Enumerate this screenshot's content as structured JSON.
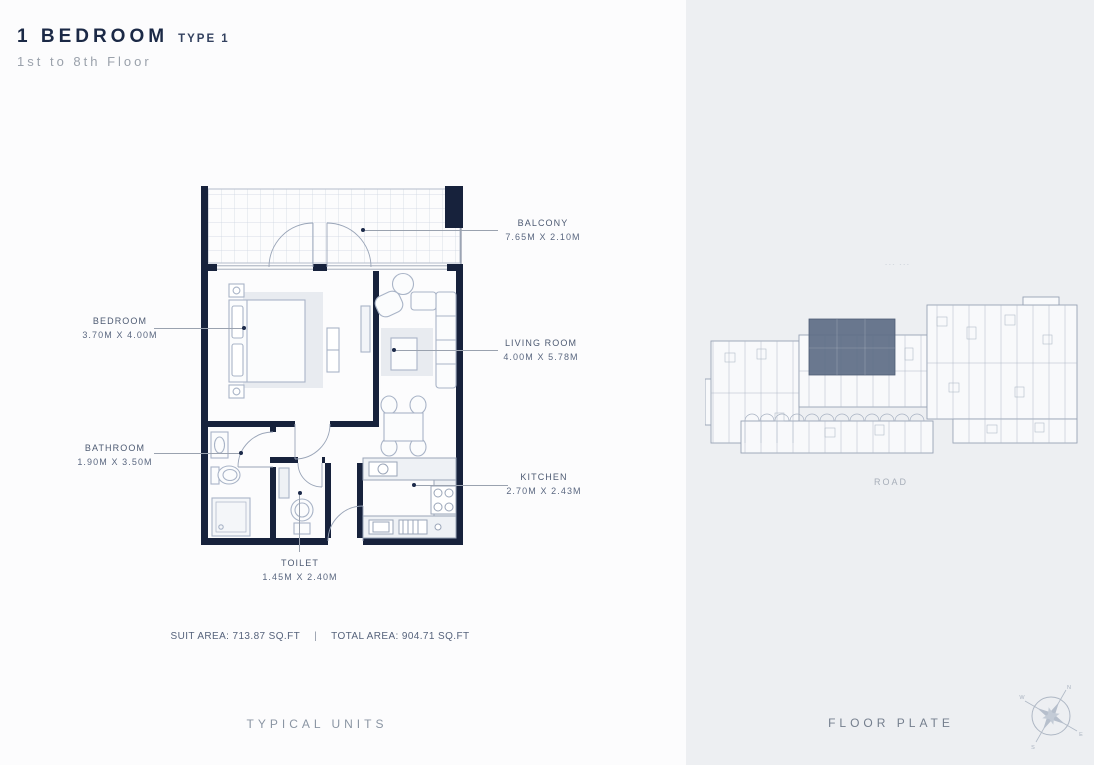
{
  "header": {
    "title": "1 BEDROOM",
    "type": "TYPE 1",
    "floors": "1st to 8th Floor"
  },
  "unit_plan": {
    "rooms": [
      {
        "name": "BALCONY",
        "dims": "7.65M X 2.10M"
      },
      {
        "name": "BEDROOM",
        "dims": "3.70M X 4.00M"
      },
      {
        "name": "LIVING ROOM",
        "dims": "4.00M X 5.78M"
      },
      {
        "name": "BATHROOM",
        "dims": "1.90M X 3.50M"
      },
      {
        "name": "TOILET",
        "dims": "1.45M X 2.40M"
      },
      {
        "name": "KITCHEN",
        "dims": "2.70M X 2.43M"
      }
    ],
    "areas": {
      "suit": "SUIT AREA: 713.87 SQ.FT",
      "separator": "|",
      "total": "TOTAL AREA: 904.71 SQ.FT"
    },
    "section_label": "TYPICAL UNITS"
  },
  "floor_plate": {
    "section_label": "FLOOR PLATE",
    "road_label": "ROAD",
    "tick_marks": "--- ---",
    "compass": {
      "n": "N",
      "e": "E",
      "s": "S",
      "w": "W"
    }
  },
  "colors": {
    "wall": "#17223C",
    "accent_navy": "#1B2946",
    "panel_bg": "#EDEFF2",
    "highlight_unit": "#5F6E86",
    "plan_line": "#9AA5B8",
    "muted_text": "#8D96A4"
  }
}
